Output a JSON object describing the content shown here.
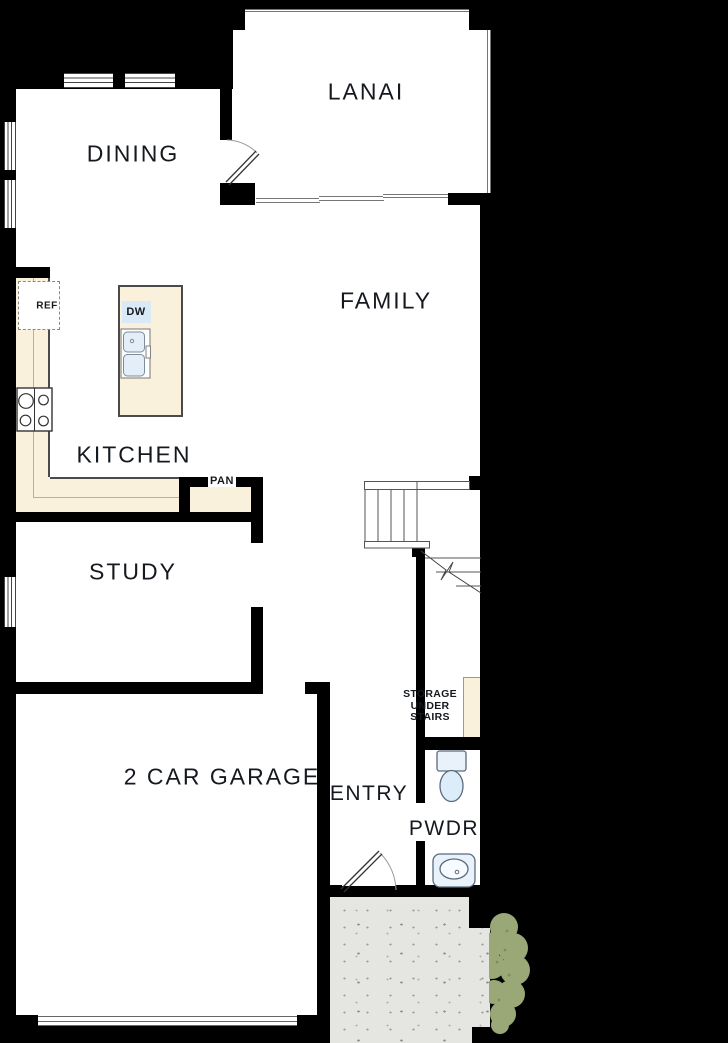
{
  "colors": {
    "background": "#000000",
    "wall": "#000000",
    "floor": "#ffffff",
    "counter": "#faf1dd",
    "appliance_blue": "#d9eaf6",
    "fixture_stroke": "#5a6b7c",
    "porch_concrete": "#e5e5e2",
    "bush_green": "#9aa878",
    "label_text": "#15191f",
    "thin_line": "#777777"
  },
  "rooms": {
    "lanai": {
      "label": "LANAI"
    },
    "dining": {
      "label": "DINING"
    },
    "family": {
      "label": "FAMILY"
    },
    "kitchen": {
      "label": "KITCHEN"
    },
    "study": {
      "label": "STUDY"
    },
    "garage": {
      "label": "2 CAR GARAGE"
    },
    "entry": {
      "label": "ENTRY"
    },
    "powder": {
      "label": "PWDR"
    }
  },
  "annotations": {
    "refrigerator": {
      "label": "REF"
    },
    "dishwasher": {
      "label": "DW"
    },
    "pantry": {
      "label": "PAN"
    },
    "storage": {
      "line1": "STORAGE",
      "line2": "UNDER",
      "line3": "STAIRS"
    }
  }
}
